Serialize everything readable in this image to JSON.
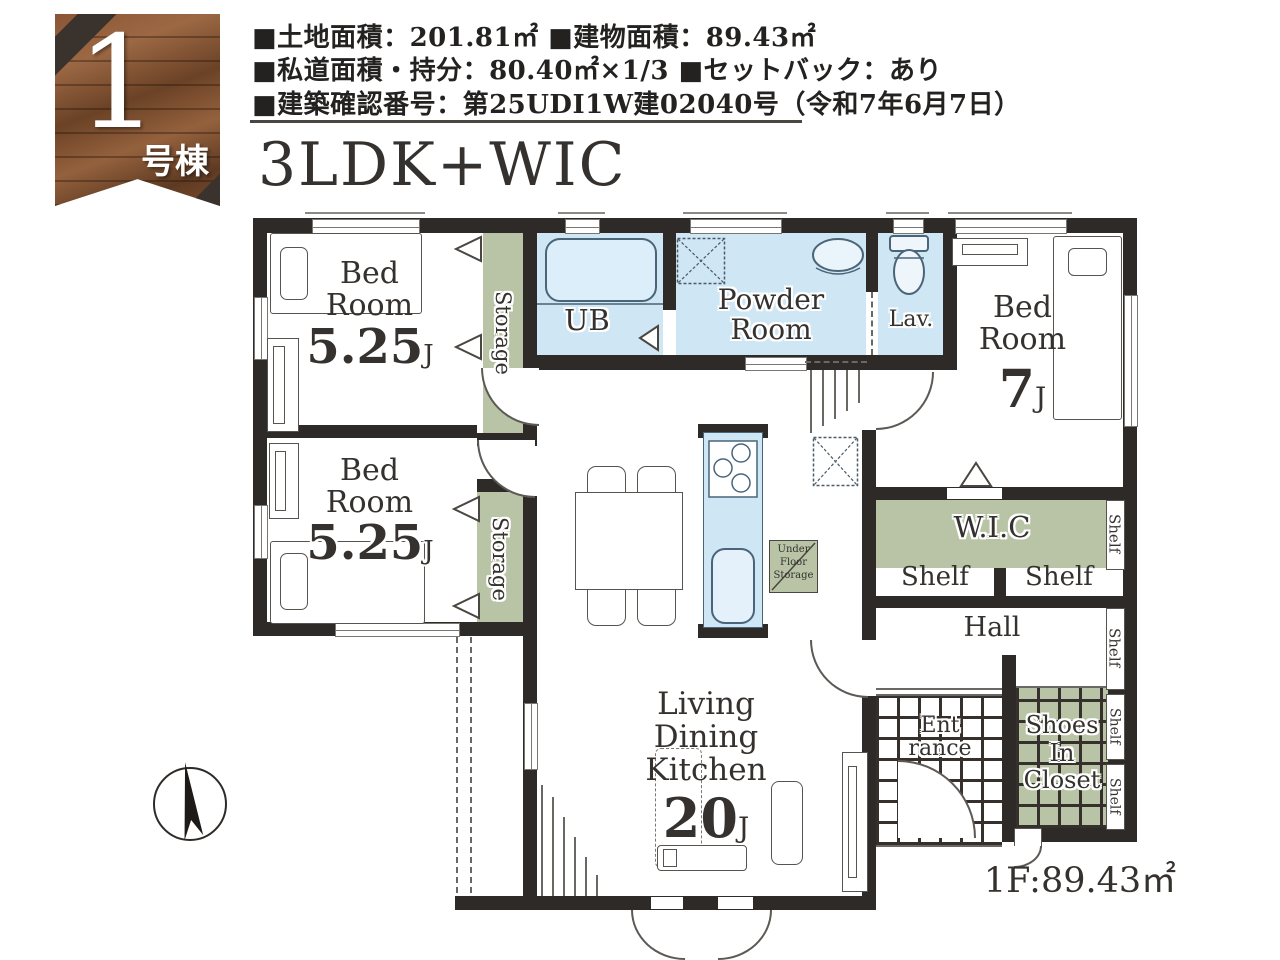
{
  "badge": {
    "number": "1",
    "label": "号棟"
  },
  "header": {
    "line1": "■土地面積：201.81㎡ ■建物面積：89.43㎡",
    "line2": "■私道面積・持分：80.40㎡×1/3 ■セットバック：あり",
    "line3": "■建築確認番号：第25UDI1W建02040号（令和7年6月7日）"
  },
  "plan": {
    "title": "3LDK+WIC",
    "floor_area": "1F:89.43㎡",
    "rooms": {
      "bedroom_top_left": {
        "name": "Bed Room",
        "size": "5.25",
        "unit": "J"
      },
      "bedroom_bottom_left": {
        "name": "Bed Room",
        "size": "5.25",
        "unit": "J"
      },
      "bedroom_right": {
        "name": "Bed Room",
        "size": "7",
        "unit": "J"
      },
      "ldk": {
        "name": "Living Dining Kitchen",
        "size": "20",
        "unit": "J"
      },
      "ub": "UB",
      "powder_room": "Powder Room",
      "lavatory": "Lav.",
      "wic": "W.I.C",
      "hall": "Hall",
      "entrance": {
        "line1": "Ent",
        "line2": "rance"
      },
      "shoes_closet": {
        "line1": "Shoes",
        "line2": "In",
        "line3": "Closet"
      },
      "storage_top": "Storage",
      "storage_bottom": "Storage",
      "under_floor_storage": {
        "line1": "Under",
        "line2": "Floor",
        "line3": "Storage"
      }
    },
    "shelf_labels": [
      "Shelf",
      "Shelf",
      "Shelf",
      "Shelf",
      "Shelf",
      "Shelf"
    ],
    "colors": {
      "wall": "#2e2a27",
      "water": "#cfe6f5",
      "sage": "#b8c4a5"
    }
  }
}
